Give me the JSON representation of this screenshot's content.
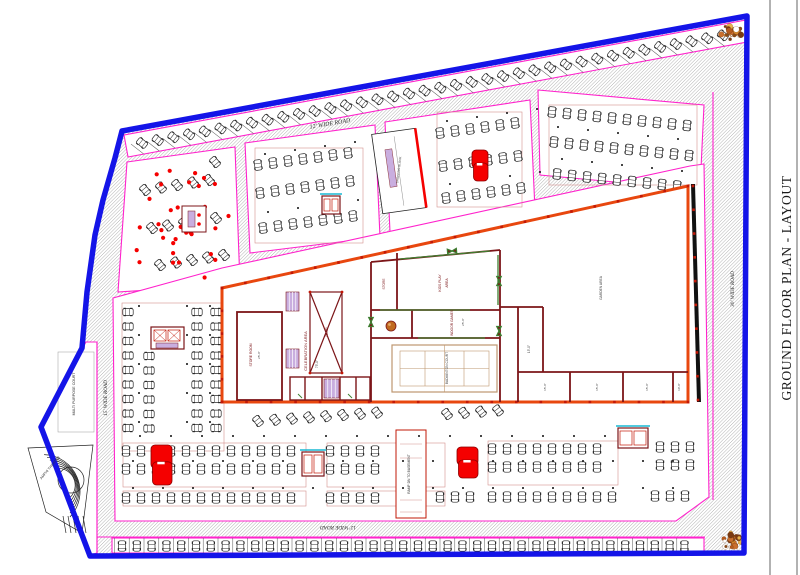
{
  "title": {
    "text": "GROUND FLOOR PLAN - LAYOUT"
  },
  "colors": {
    "boundary_blue": "#1414E8",
    "parcel_magenta": "#FF22CC",
    "building_orange": "#E8470F",
    "building_black": "#111111",
    "wall_maroon": "#7C1518",
    "wall_green": "#3E7E30",
    "window_lavender": "#C9AEDF",
    "court_tan": "#BE9770",
    "highlight_red": "#F50000",
    "lift_cyan": "#18B9D4",
    "aisle_pink": "#D4908E",
    "hatch_gray": "#8a8a8a",
    "column_red": "#C21807"
  },
  "labels": [
    {
      "id": "title",
      "text": "GROUND FLOOR PLAN - LAYOUT",
      "x": 788,
      "y": 288,
      "r": -90,
      "s": 13.5,
      "c": "#1a1a1a",
      "serif": true,
      "sp": 0.6
    },
    {
      "id": "road-top",
      "text": "12' WIDE ROAD",
      "x": 330,
      "y": 124,
      "r": -9.5,
      "s": 6,
      "c": "#2b2b2b",
      "serif": true,
      "italic": true
    },
    {
      "id": "road-right",
      "text": "30' WIDE ROAD",
      "x": 733,
      "y": 289,
      "r": -90,
      "s": 5.2,
      "c": "#2b2b2b",
      "serif": true,
      "italic": true
    },
    {
      "id": "road-left",
      "text": "15' WIDE ROAD",
      "x": 106,
      "y": 398,
      "r": -90,
      "s": 5.2,
      "c": "#2b2b2b",
      "serif": true,
      "italic": true
    },
    {
      "id": "road-bottom",
      "text": "12' WIDE ROAD",
      "x": 338,
      "y": 527,
      "r": 180,
      "s": 5.2,
      "c": "#2b2b2b",
      "serif": true,
      "italic": true
    },
    {
      "id": "multi-purpose-court",
      "text": "MULTI PURPOSE COURT",
      "x": 74,
      "y": 394,
      "r": -90,
      "s": 3.6,
      "c": "#333333"
    },
    {
      "id": "amphi-theater",
      "text": "AMPHI THEATER",
      "x": 50,
      "y": 468,
      "r": -50,
      "s": 3.6,
      "c": "#333333"
    },
    {
      "id": "ramp-dn-to-basement",
      "text": "RAMP DN TO BASEMENT",
      "x": 409,
      "y": 474,
      "r": -90,
      "s": 3.3,
      "c": "#333333"
    },
    {
      "id": "celebration-area",
      "text": "CELEBRATION AREA",
      "x": 306,
      "y": 351,
      "r": -90,
      "s": 4,
      "c": "#7C1518"
    },
    {
      "id": "celebration-dim",
      "text": "75'-0\"",
      "x": 317,
      "y": 364,
      "r": -90,
      "s": 3.2,
      "c": "#444444"
    },
    {
      "id": "store-room",
      "text": "STORE ROOM",
      "x": 251,
      "y": 355,
      "r": -90,
      "s": 3.4,
      "c": "#7C1518"
    },
    {
      "id": "store-room-dim",
      "text": "25'-0\"",
      "x": 259,
      "y": 355,
      "r": -90,
      "s": 3,
      "c": "#444444"
    },
    {
      "id": "ramp",
      "text": "RAMP",
      "x": 327,
      "y": 332,
      "r": -90,
      "s": 3.2,
      "c": "#7C1518"
    },
    {
      "id": "kids-play",
      "text": "KIDS PLAY",
      "x": 440,
      "y": 283,
      "r": -90,
      "s": 3.4,
      "c": "#7C1518"
    },
    {
      "id": "kids-play-2",
      "text": "AREA",
      "x": 447,
      "y": 283,
      "r": -90,
      "s": 3.4,
      "c": "#7C1518"
    },
    {
      "id": "store-small",
      "text": "STORE",
      "x": 384,
      "y": 284,
      "r": -90,
      "s": 3.2,
      "c": "#7C1518"
    },
    {
      "id": "indoor-games",
      "text": "INDOOR GAMES",
      "x": 452,
      "y": 323,
      "r": -90,
      "s": 3.3,
      "c": "#7C1518"
    },
    {
      "id": "indoor-games-dim",
      "text": "25'-0\"",
      "x": 463,
      "y": 322,
      "r": -90,
      "s": 3,
      "c": "#444444"
    },
    {
      "id": "badminton-court",
      "text": "BADMINTON COURT",
      "x": 447,
      "y": 368,
      "r": -90,
      "s": 3.3,
      "c": "#4a4a4a"
    },
    {
      "id": "garden-area",
      "text": "GARDEN AREA",
      "x": 601,
      "y": 288,
      "r": -90,
      "s": 3.3,
      "c": "#4a4a4a"
    },
    {
      "id": "corridor-dim",
      "text": "15'-0\"",
      "x": 529,
      "y": 349,
      "r": -90,
      "s": 3.2,
      "c": "#444444"
    },
    {
      "id": "shop-dim-1",
      "text": "15'-0\"",
      "x": 545,
      "y": 387,
      "r": -90,
      "s": 3,
      "c": "#444444"
    },
    {
      "id": "shop-dim-2",
      "text": "15'-0\"",
      "x": 597,
      "y": 387,
      "r": -90,
      "s": 3,
      "c": "#444444"
    },
    {
      "id": "shop-dim-3",
      "text": "15'-0\"",
      "x": 647,
      "y": 387,
      "r": -90,
      "s": 3,
      "c": "#444444"
    },
    {
      "id": "shop-dim-4",
      "text": "10'-0\"",
      "x": 679,
      "y": 387,
      "r": -90,
      "s": 3,
      "c": "#444444"
    },
    {
      "id": "shopping-block",
      "text": "SHOPPING BLOCK",
      "x": 399,
      "y": 170,
      "r": -83,
      "s": 3,
      "c": "#333333"
    }
  ],
  "parking_rows": [
    {
      "id": "top-strip",
      "x": 142,
      "y": 143,
      "n": 38,
      "dx": 15.7,
      "dy": -2.91,
      "rot": -52,
      "stall": true
    },
    {
      "id": "bottom-strip",
      "x": 122,
      "y": 546,
      "n": 39,
      "dx": 14.8,
      "dy": 0,
      "rot": 0,
      "stall": true
    },
    {
      "id": "inner-ring",
      "x": 250,
      "y": 290,
      "n": 27,
      "dx": 16.2,
      "dy": -3.55,
      "rot": -13
    },
    {
      "id": "p1-a",
      "x": 145,
      "y": 190,
      "n": 5,
      "dx": 16,
      "dy": -2.5,
      "rot": -40
    },
    {
      "id": "p1-b",
      "x": 152,
      "y": 228,
      "n": 5,
      "dx": 16,
      "dy": -2.5,
      "rot": -40
    },
    {
      "id": "p1-c",
      "x": 160,
      "y": 265,
      "n": 5,
      "dx": 16,
      "dy": -2.5,
      "rot": -40
    },
    {
      "id": "p1-d",
      "x": 215,
      "y": 162,
      "n": 1,
      "dx": 0,
      "dy": 0,
      "rot": -40
    },
    {
      "id": "p2-a",
      "x": 258,
      "y": 165,
      "n": 7,
      "dx": 15,
      "dy": -2,
      "rot": -8
    },
    {
      "id": "p2-b",
      "x": 260,
      "y": 193,
      "n": 7,
      "dx": 15,
      "dy": -2,
      "rot": 172
    },
    {
      "id": "p2-c",
      "x": 263,
      "y": 228,
      "n": 7,
      "dx": 15,
      "dy": -2,
      "rot": -8
    },
    {
      "id": "p3-a",
      "x": 440,
      "y": 133,
      "n": 6,
      "dx": 15,
      "dy": -2,
      "rot": -8
    },
    {
      "id": "p3-b",
      "x": 443,
      "y": 166,
      "n": 6,
      "dx": 15,
      "dy": -2,
      "rot": 172
    },
    {
      "id": "p3-c",
      "x": 446,
      "y": 198,
      "n": 6,
      "dx": 15,
      "dy": -2,
      "rot": -8
    },
    {
      "id": "p4-a",
      "x": 552,
      "y": 112,
      "n": 10,
      "dx": 15,
      "dy": 1.5,
      "rot": 6
    },
    {
      "id": "p4-b",
      "x": 554,
      "y": 142,
      "n": 10,
      "dx": 15,
      "dy": 1.5,
      "rot": 186
    },
    {
      "id": "p4-c",
      "x": 557,
      "y": 174,
      "n": 9,
      "dx": 15,
      "dy": 1.5,
      "rot": 6
    },
    {
      "id": "p5-col-a",
      "x": 128,
      "y": 312,
      "n": 9,
      "dx": 0,
      "dy": 14.5,
      "rot": 90
    },
    {
      "id": "p5-col-b",
      "x": 149,
      "y": 356,
      "n": 6,
      "dx": 0,
      "dy": 14.5,
      "rot": -90
    },
    {
      "id": "p5-col-c",
      "x": 197,
      "y": 312,
      "n": 9,
      "dx": 0,
      "dy": 14.5,
      "rot": 90
    },
    {
      "id": "p5-col-d",
      "x": 216,
      "y": 312,
      "n": 9,
      "dx": 0,
      "dy": 14.5,
      "rot": -90
    },
    {
      "id": "p6-angled-a",
      "x": 258,
      "y": 421,
      "n": 8,
      "dx": 17,
      "dy": -1.2,
      "rot": -38
    },
    {
      "id": "p6-angled-b",
      "x": 447,
      "y": 414,
      "n": 4,
      "dx": 17,
      "dy": -1.2,
      "rot": -38
    },
    {
      "id": "p6-r1-a",
      "x": 126,
      "y": 451,
      "n": 12,
      "dx": 15,
      "dy": 0,
      "rot": 0
    },
    {
      "id": "p6-r1-b",
      "x": 330,
      "y": 451,
      "n": 4,
      "dx": 15,
      "dy": 0,
      "rot": 0
    },
    {
      "id": "p6-r1-c",
      "x": 492,
      "y": 449,
      "n": 8,
      "dx": 15,
      "dy": 0,
      "rot": 0
    },
    {
      "id": "p6-r1-d",
      "x": 660,
      "y": 447,
      "n": 3,
      "dx": 15,
      "dy": 0,
      "rot": 0
    },
    {
      "id": "p6-r2-a",
      "x": 126,
      "y": 469,
      "n": 12,
      "dx": 15,
      "dy": 0,
      "rot": 180
    },
    {
      "id": "p6-r2-b",
      "x": 330,
      "y": 469,
      "n": 4,
      "dx": 15,
      "dy": 0,
      "rot": 180
    },
    {
      "id": "p6-r2-c",
      "x": 492,
      "y": 467,
      "n": 8,
      "dx": 15,
      "dy": 0,
      "rot": 180
    },
    {
      "id": "p6-r2-d",
      "x": 660,
      "y": 465,
      "n": 3,
      "dx": 15,
      "dy": 0,
      "rot": 180
    },
    {
      "id": "p6-r3-a",
      "x": 126,
      "y": 498,
      "n": 12,
      "dx": 15,
      "dy": 0,
      "rot": 0
    },
    {
      "id": "p6-r3-b",
      "x": 330,
      "y": 498,
      "n": 4,
      "dx": 15,
      "dy": 0,
      "rot": 0
    },
    {
      "id": "p6-r3-c",
      "x": 440,
      "y": 497,
      "n": 3,
      "dx": 15,
      "dy": 0,
      "rot": 0
    },
    {
      "id": "p6-r3-d",
      "x": 492,
      "y": 497,
      "n": 9,
      "dx": 15,
      "dy": 0,
      "rot": 0
    },
    {
      "id": "p6-r3-e",
      "x": 655,
      "y": 496,
      "n": 3,
      "dx": 15,
      "dy": 0,
      "rot": 0
    }
  ],
  "marker_dot_rows": [
    {
      "x": 133,
      "y": 461,
      "n": 19,
      "dx": 30,
      "dy": 0
    },
    {
      "x": 133,
      "y": 488,
      "n": 19,
      "dx": 30,
      "dy": 0
    },
    {
      "x": 140,
      "y": 436,
      "n": 17,
      "dx": 31,
      "dy": 0
    },
    {
      "x": 265,
      "y": 154,
      "n": 4,
      "dx": 30,
      "dy": -4
    },
    {
      "x": 268,
      "y": 212,
      "n": 4,
      "dx": 30,
      "dy": -4
    },
    {
      "x": 447,
      "y": 121,
      "n": 4,
      "dx": 30,
      "dy": -4
    },
    {
      "x": 450,
      "y": 184,
      "n": 4,
      "dx": 30,
      "dy": -4
    },
    {
      "x": 558,
      "y": 127,
      "n": 5,
      "dx": 30,
      "dy": 3
    },
    {
      "x": 562,
      "y": 159,
      "n": 5,
      "dx": 30,
      "dy": 3
    },
    {
      "x": 139,
      "y": 306,
      "n": 5,
      "dx": 0,
      "dy": 29
    },
    {
      "x": 187,
      "y": 306,
      "n": 5,
      "dx": 0,
      "dy": 29
    },
    {
      "x": 210,
      "y": 306,
      "n": 5,
      "dx": 0,
      "dy": 29
    },
    {
      "x": 258,
      "y": 299,
      "n": 14,
      "dx": 31,
      "dy": -6.8
    }
  ],
  "aisle_guides": [
    {
      "x": 123,
      "y": 443,
      "w": 183,
      "h": 44
    },
    {
      "x": 327,
      "y": 443,
      "w": 118,
      "h": 44
    },
    {
      "x": 488,
      "y": 441,
      "w": 130,
      "h": 44
    },
    {
      "x": 123,
      "y": 491,
      "w": 183,
      "h": 15
    },
    {
      "x": 327,
      "y": 491,
      "w": 118,
      "h": 15
    },
    {
      "x": 122,
      "y": 303,
      "w": 102,
      "h": 148
    },
    {
      "x": 255,
      "y": 148,
      "w": 108,
      "h": 95
    },
    {
      "x": 437,
      "y": 112,
      "w": 85,
      "h": 95
    },
    {
      "x": 549,
      "y": 105,
      "w": 148,
      "h": 80
    }
  ],
  "red_cores": [
    {
      "id": "stair-core-west",
      "x": 151,
      "y": 445,
      "w": 21,
      "h": 40
    },
    {
      "id": "stair-core-center",
      "x": 457,
      "y": 447,
      "w": 21,
      "h": 31
    },
    {
      "id": "stair-core-north",
      "x": 472,
      "y": 150,
      "w": 16,
      "h": 31
    }
  ],
  "lift_cores": [
    {
      "id": "lift-core-south-west",
      "x": 302,
      "y": 452,
      "w": 22,
      "h": 24
    },
    {
      "id": "lift-core-south-east",
      "x": 618,
      "y": 428,
      "w": 30,
      "h": 20
    },
    {
      "id": "lift-core-north",
      "x": 322,
      "y": 196,
      "w": 18,
      "h": 18
    }
  ],
  "trees": [
    {
      "id": "tree-north-east",
      "x": 731,
      "y": 33
    },
    {
      "id": "tree-south-east",
      "x": 733,
      "y": 541
    }
  ],
  "red_dot_field": {
    "count": 34,
    "x": 132,
    "y": 168,
    "w": 98,
    "h": 112
  }
}
